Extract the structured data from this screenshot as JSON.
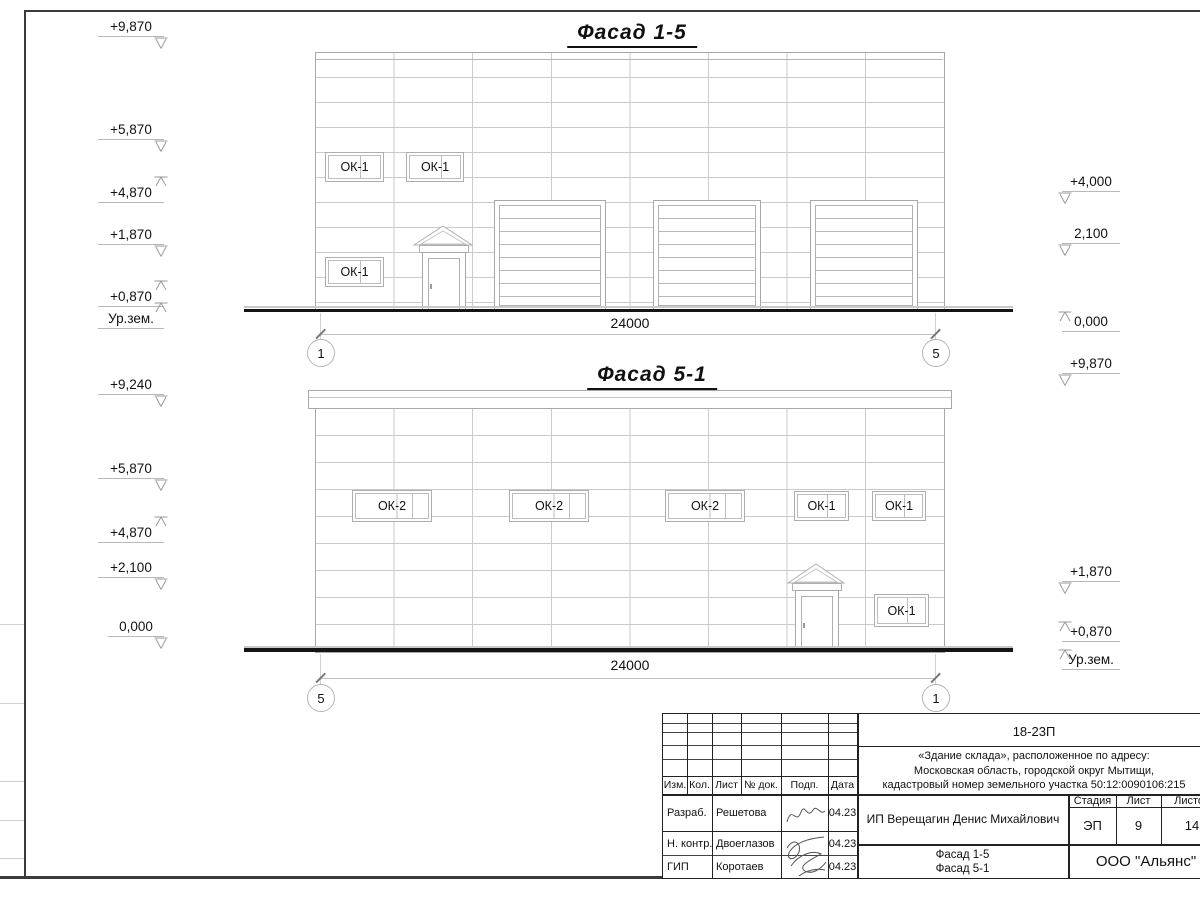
{
  "facades": {
    "top": {
      "title": "Фасад 1-5",
      "dimension": "24000",
      "axis_left": "1",
      "axis_right": "5",
      "windows": [
        {
          "label": "ОК-1"
        },
        {
          "label": "ОК-1"
        },
        {
          "label": "ОК-1"
        }
      ],
      "marks_left": [
        {
          "label": "+9,870"
        },
        {
          "label": "+5,870"
        },
        {
          "label": "+4,870"
        },
        {
          "label": "+1,870"
        },
        {
          "label": "+0,870"
        },
        {
          "label": "Ур.зем."
        }
      ],
      "marks_right": [
        {
          "label": "+4,000"
        },
        {
          "label": "2,100"
        },
        {
          "label": "0,000"
        },
        {
          "label": "+9,870"
        }
      ]
    },
    "bottom": {
      "title": "Фасад 5-1",
      "dimension": "24000",
      "axis_left": "5",
      "axis_right": "1",
      "windows": [
        {
          "label": "ОК-2"
        },
        {
          "label": "ОК-2"
        },
        {
          "label": "ОК-2"
        },
        {
          "label": "ОК-1"
        },
        {
          "label": "ОК-1"
        },
        {
          "label": "ОК-1"
        }
      ],
      "marks_left": [
        {
          "label": "+9,240"
        },
        {
          "label": "+5,870"
        },
        {
          "label": "+4,870"
        },
        {
          "label": "+2,100"
        },
        {
          "label": "0,000"
        }
      ],
      "marks_right": [
        {
          "label": "+1,870"
        },
        {
          "label": "+0,870"
        },
        {
          "label": "Ур.зем."
        }
      ]
    }
  },
  "title_block": {
    "code": "18-23П",
    "address_line1": "«Здание склада», расположенное по адресу:",
    "address_line2": "Московская область, городской округ Мытищи,",
    "address_line3": "кадастровый номер земельного участка 50:12:0090106:215",
    "client": "ИП Верещагин Денис Михайлович",
    "cols": {
      "izm": "Изм.",
      "kol": "Кол.",
      "list": "Лист",
      "doc": "№ док.",
      "podp": "Подп.",
      "data": "Дата"
    },
    "stage_label": "Стадия",
    "sheet_label": "Лист",
    "sheets_label": "Листов",
    "stage": "ЭП",
    "sheet": "9",
    "sheets": "14",
    "rows": [
      {
        "role": "Разраб.",
        "name": "Решетова",
        "date": "04.23"
      },
      {
        "role": "Н. контр.",
        "name": "Двоеглазов",
        "date": "04.23"
      },
      {
        "role": "ГИП",
        "name": "Коротаев",
        "date": "04.23"
      }
    ],
    "doc_title_line1": "Фасад 1-5",
    "doc_title_line2": "Фасад 5-1",
    "company": "ООО \"Альянс\""
  }
}
